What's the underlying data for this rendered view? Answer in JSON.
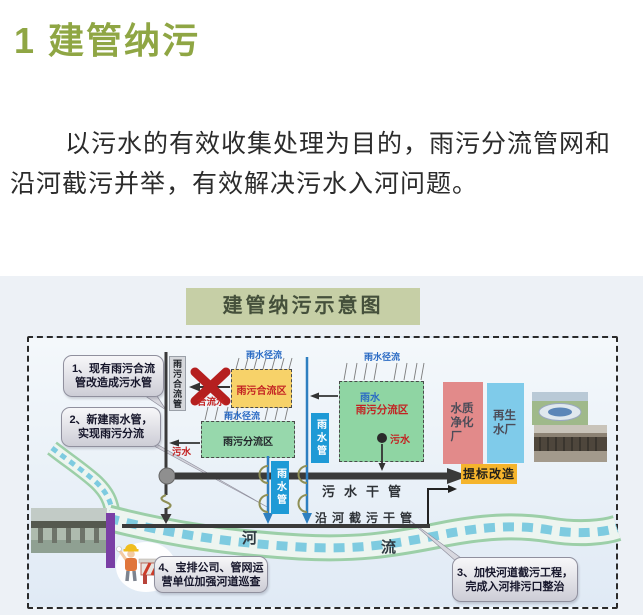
{
  "header": {
    "section_title": "1 建管纳污",
    "intro": "以污水的有效收集处理为目的，雨污分流管网和沿河截污并举，有效解决污水入河问题。"
  },
  "diagram": {
    "title": "建管纳污示意图",
    "callout1": {
      "line1": "1、现有雨污合流",
      "line2": "管改造成污水管"
    },
    "callout2": {
      "line1": "2、新建雨水管，",
      "line2": "实现雨污分流"
    },
    "callout3": {
      "line1": "3、加快河道截污工程，",
      "line2": "完成入河排污口整治"
    },
    "callout4": {
      "line1": "4、宝排公司、管网运",
      "line2": "营单位加强河道巡查"
    },
    "labels": {
      "combined_sewer_pipe": "雨污合流管",
      "rain_runoff": "雨水径流",
      "combined_zone": "雨污合流区",
      "combined_water": "合流水",
      "separate_zone": "雨污分流区",
      "sewage": "污水",
      "rainwater": "雨水",
      "rain_pipe": "雨水管",
      "sewage_main": "污水干管",
      "river_intercepting_main": "沿河截污干管",
      "upgrade_retrofit": "提标改造",
      "water_purification_plant": "水质净化厂",
      "reclaimed_water_plant": "再生水厂",
      "river_char_he": "河",
      "river_char_liu": "流"
    },
    "colors": {
      "heading_green": "#8FA644",
      "title_box_bg": "#C6CFA6",
      "combined_zone_yellow": "#F7D269",
      "separate_zone_green": "#93D7A8",
      "rain_pipe_blue": "#1E9AD6",
      "upgrade_yellow": "#F5B42C",
      "purification_pink": "#E28A8A",
      "reclaimed_blue": "#7FCBEA",
      "alert_red": "#B51F1F",
      "label_blue": "#2B6BC4",
      "label_red": "#C32222",
      "pipe_dark": "#3A3A3A",
      "river_dash": "#7ECBE0"
    }
  }
}
